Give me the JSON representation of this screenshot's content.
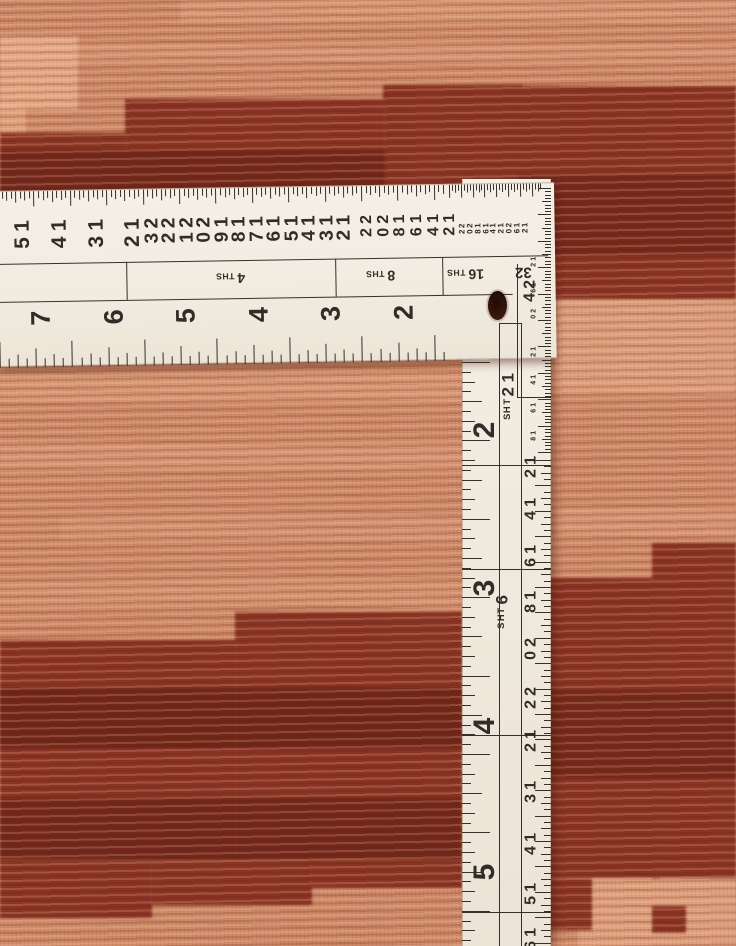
{
  "scene": {
    "subject": "L-shaped framing square ruler lying on the corner of a hand-woven wool rug with stepped salmon and maroon blocks",
    "palette": {
      "rug_salmon": "#cf8a68",
      "rug_salmon_light": "#eeb28e",
      "rug_maroon": "#8c3424",
      "rug_maroon_dark": "#4f160c",
      "ruler_white": "#f2ede3",
      "marking_black": "#302d28",
      "hole_brown": "#3a180d"
    }
  },
  "ruler": {
    "horizontal_arm": {
      "outer_scale_large": [
        "15",
        "14",
        "13",
        "12"
      ],
      "outer_scale_medium": [
        "23",
        "22",
        "21",
        "20",
        "19",
        "18",
        "17",
        "16",
        "15",
        "14",
        "13",
        "12"
      ],
      "outer_scale_small": [
        "22",
        "20",
        "18",
        "16",
        "14",
        "12"
      ],
      "outer_scale_tiny": [
        "22",
        "20",
        "18",
        "16",
        "14",
        "12",
        "20",
        "16",
        "12"
      ],
      "graduation_labels": [
        "4 THS",
        "8 THS",
        "16 THS",
        "32"
      ],
      "inch_numbers": [
        "7",
        "6",
        "5",
        "4",
        "3",
        "2"
      ],
      "corner_number": "24"
    },
    "vertical_arm": {
      "inch_numbers": [
        "2",
        "3",
        "4",
        "5"
      ],
      "graduation_labels": [
        "12 THS",
        "6 THS"
      ],
      "inner_scale_numbers": [
        "12",
        "14",
        "16",
        "18",
        "20",
        "22",
        "12",
        "13",
        "14",
        "15",
        "16"
      ],
      "edge_scale_numbers": [
        "12",
        "16",
        "20",
        "12",
        "14",
        "16",
        "18"
      ]
    }
  }
}
